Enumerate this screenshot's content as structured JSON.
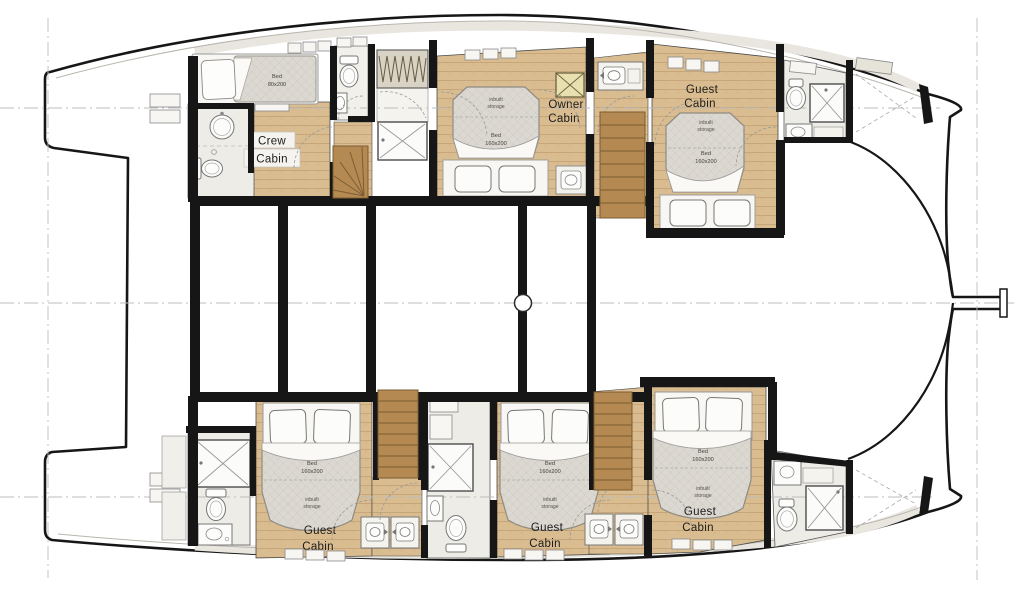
{
  "plan": {
    "title": "Catamaran lower deck floor plan",
    "cabins": [
      {
        "id": "crew-cabin",
        "line1": "Crew",
        "line2": "Cabin",
        "bed_line1": "Bed",
        "bed_line2": "80x200"
      },
      {
        "id": "owner-cabin",
        "line1": "Owner",
        "line2": "Cabin",
        "bed_line1": "Bed",
        "bed_line2": "160x200",
        "storage_line1": "inbuilt",
        "storage_line2": "storage"
      },
      {
        "id": "guest-cabin-forward-port",
        "line1": "Guest",
        "line2": "Cabin",
        "bed_line1": "Bed",
        "bed_line2": "160x200",
        "storage_line1": "inbuilt",
        "storage_line2": "storage"
      },
      {
        "id": "guest-cabin-aft-starboard",
        "line1": "Guest",
        "line2": "Cabin",
        "bed_line1": "Bed",
        "bed_line2": "160x200",
        "storage_line1": "inbuilt",
        "storage_line2": "storage"
      },
      {
        "id": "guest-cabin-mid-starboard",
        "line1": "Guest",
        "line2": "Cabin",
        "bed_line1": "Bed",
        "bed_line2": "160x200",
        "storage_line1": "inbuilt",
        "storage_line2": "storage"
      },
      {
        "id": "guest-cabin-forward-starboard",
        "line1": "Guest",
        "line2": "Cabin",
        "bed_line1": "Bed",
        "bed_line2": "160x200",
        "storage_line1": "inbuilt",
        "storage_line2": "storage"
      }
    ],
    "colors": {
      "wood_floor": "#d9bc90",
      "wood_plank_line": "#c7a679",
      "stair_wood": "#b48a52",
      "mattress": "#dbd8d1",
      "bathroom_floor": "#edece6",
      "wall": "#161616",
      "hatch": "#e9e0b0",
      "centerline": "#bdbdbd",
      "deck_band": "#e8e6df"
    }
  }
}
